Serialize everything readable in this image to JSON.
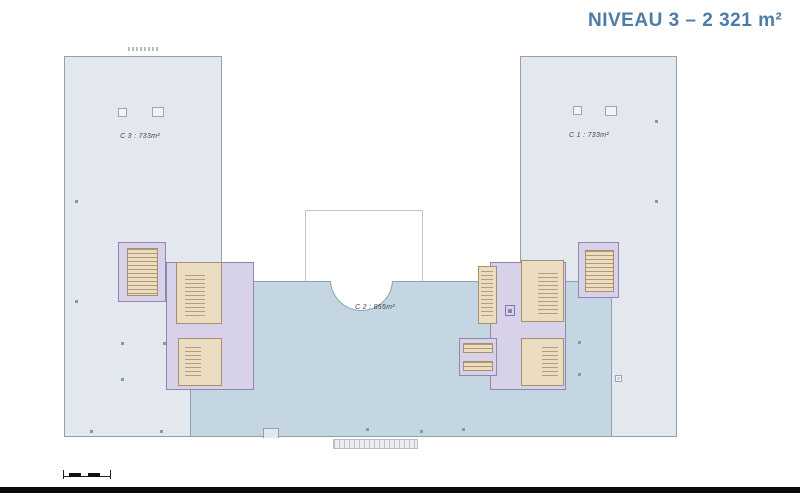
{
  "title": {
    "text": "NIVEAU 3  –  2 321 m²"
  },
  "colors": {
    "title": "#4d7ca9",
    "wing_fill": "#e2e8ee",
    "wing_border": "#93a0ac",
    "center_fill": "#c3d6e2",
    "center_border": "#8da1b0",
    "core_purple": "#d7d2e9",
    "core_purple_border": "#8f87ae",
    "stair_tan": "#ecddc2",
    "stair_tan_border": "#a8906a",
    "footer_bar": "#0a0a0a"
  },
  "plan": {
    "zones": [
      {
        "id": "c3",
        "label": "C 3 : 733m²"
      },
      {
        "id": "c2",
        "label": "C 2 : 855m²"
      },
      {
        "id": "c1",
        "label": "C 1 : 733m²"
      }
    ],
    "column_dots": [
      [
        121,
        342
      ],
      [
        163,
        342
      ],
      [
        121,
        378
      ],
      [
        90,
        430
      ],
      [
        160,
        430
      ],
      [
        578,
        341
      ],
      [
        578,
        373
      ],
      [
        617,
        377
      ],
      [
        655,
        120
      ],
      [
        655,
        200
      ],
      [
        366,
        428
      ],
      [
        420,
        430
      ],
      [
        462,
        428
      ],
      [
        75,
        200
      ],
      [
        75,
        300
      ]
    ],
    "column_squares": [
      [
        118,
        108,
        9,
        9
      ],
      [
        152,
        107,
        12,
        10
      ],
      [
        573,
        106,
        9,
        9
      ],
      [
        605,
        106,
        12,
        10
      ],
      [
        615,
        375,
        7,
        7
      ]
    ]
  },
  "scalebar": {
    "segments": 2
  }
}
